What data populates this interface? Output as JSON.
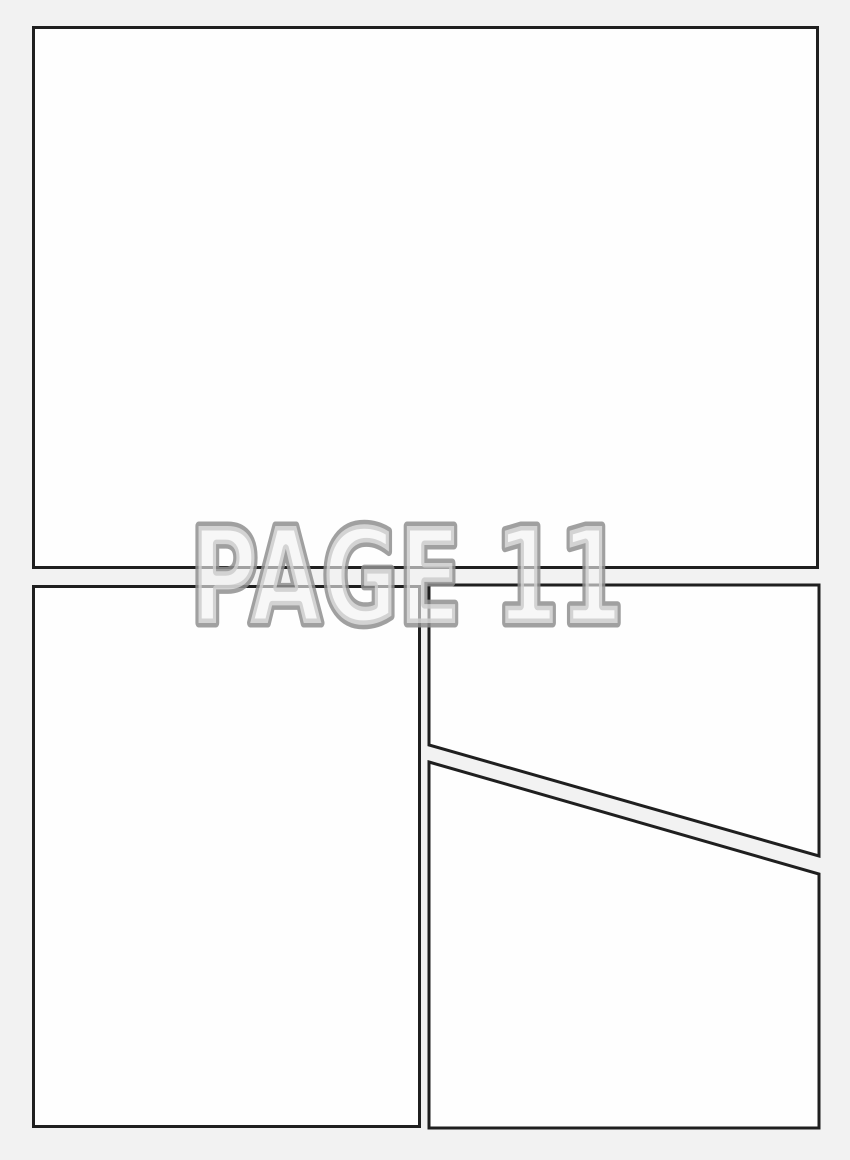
{
  "page": {
    "label": "PAGE 11"
  },
  "colors": {
    "background": "#f2f2f2",
    "panel_fill": "#fefefe",
    "panel_border": "#1f1f1f",
    "label_fill": "#f2f2f2",
    "label_outline": "#8f8f8f"
  },
  "panels": [
    {
      "id": "panel-1"
    },
    {
      "id": "panel-2"
    },
    {
      "id": "panel-3"
    },
    {
      "id": "panel-4"
    }
  ]
}
